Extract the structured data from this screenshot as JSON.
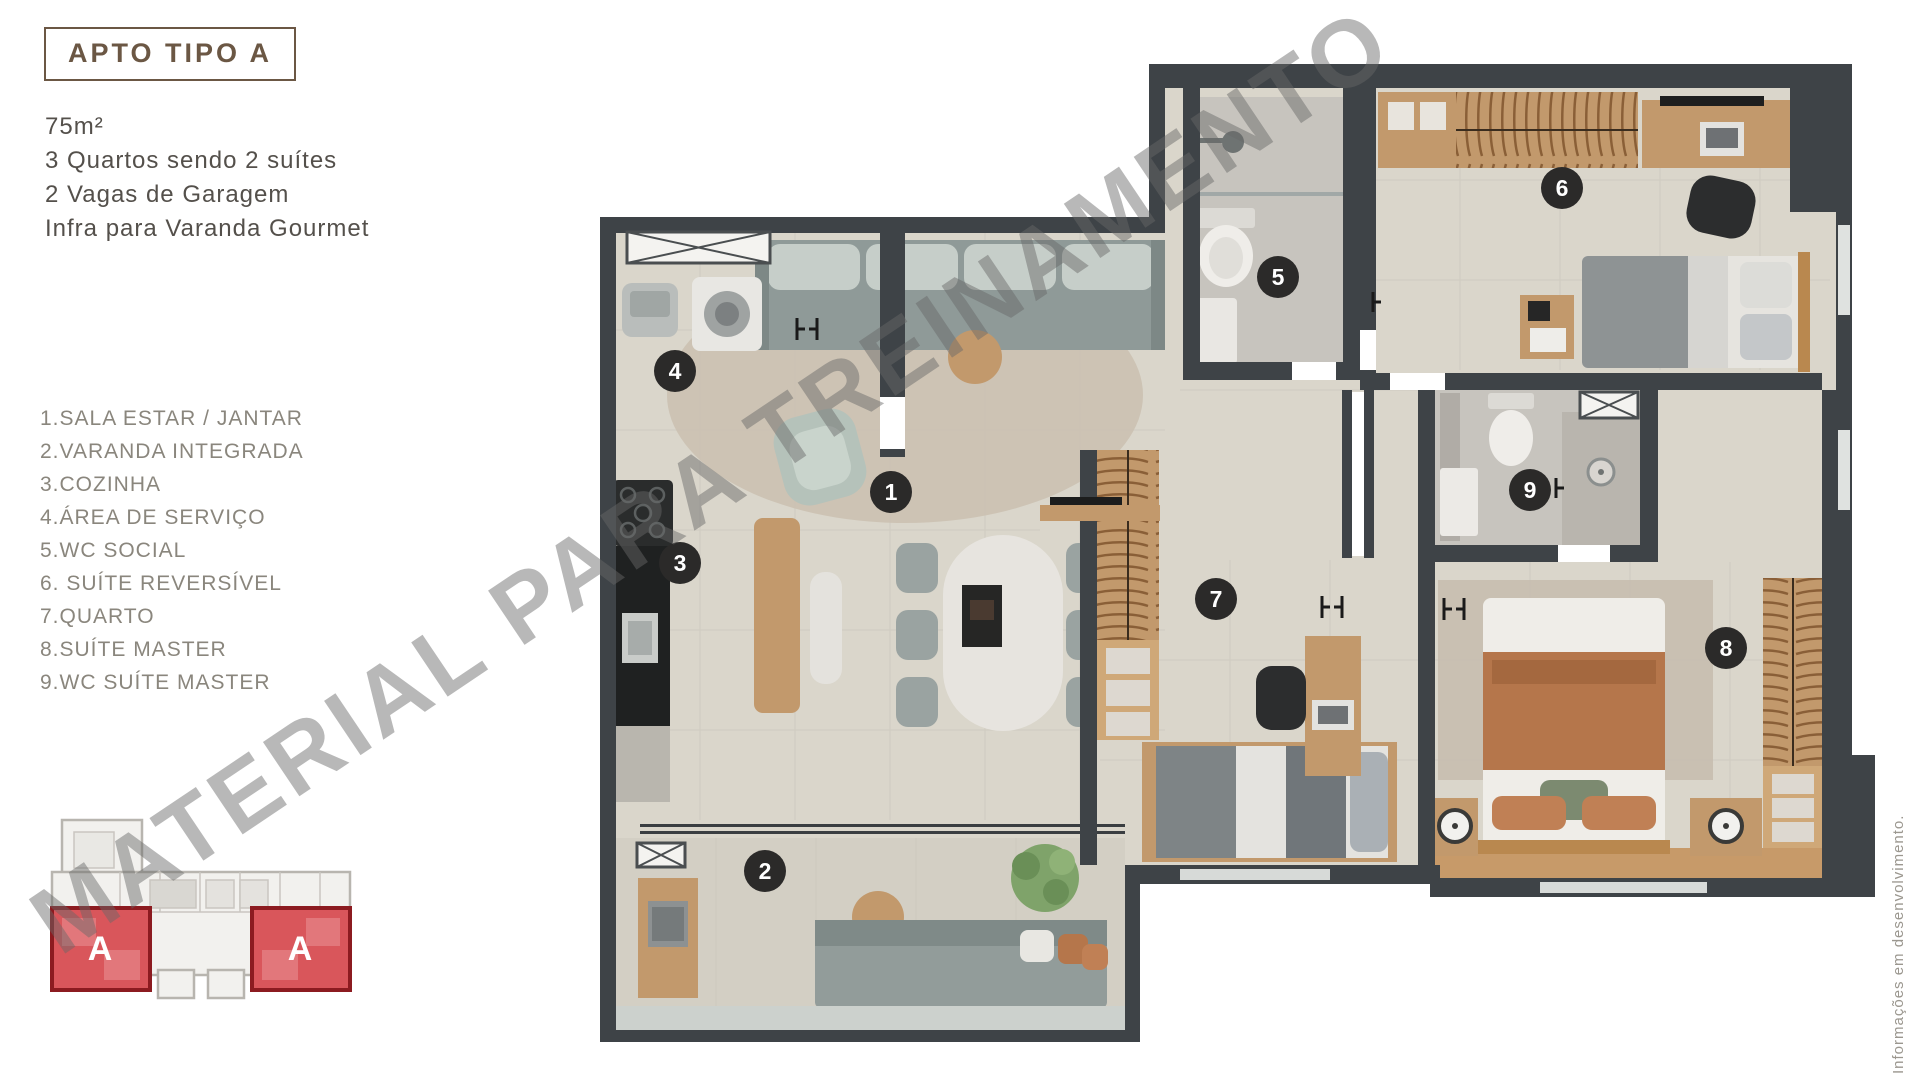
{
  "header": {
    "title": "APTO TIPO A"
  },
  "specs": {
    "lines": [
      "75m²",
      "3 Quartos sendo 2 suítes",
      "2 Vagas de Garagem",
      "Infra para Varanda Gourmet"
    ]
  },
  "legend": {
    "items": [
      "1.SALA ESTAR / JANTAR",
      "2.VARANDA INTEGRADA",
      "3.COZINHA",
      "4.ÁREA DE SERVIÇO",
      "5.WC SOCIAL",
      "6. SUÍTE REVERSÍVEL",
      "7.QUARTO",
      "8.SUÍTE MASTER",
      "9.WC SUÍTE MASTER"
    ]
  },
  "floor_plan": {
    "markers": [
      "1",
      "2",
      "3",
      "4",
      "5",
      "6",
      "7",
      "8",
      "9"
    ],
    "marker_color": "#2b2a29",
    "wall_color": "#3e4347",
    "floor_color": "#dad6cb",
    "wood_color": "#c2996c"
  },
  "key_plan": {
    "unit_labels": [
      "A",
      "A"
    ],
    "highlight_color": "#d9565b",
    "border_color": "#8c1b20"
  },
  "watermark": {
    "text": "MATERIAL PARA TREINAMENTO"
  },
  "footnote": {
    "text": "Informações em desenvolvimento."
  }
}
